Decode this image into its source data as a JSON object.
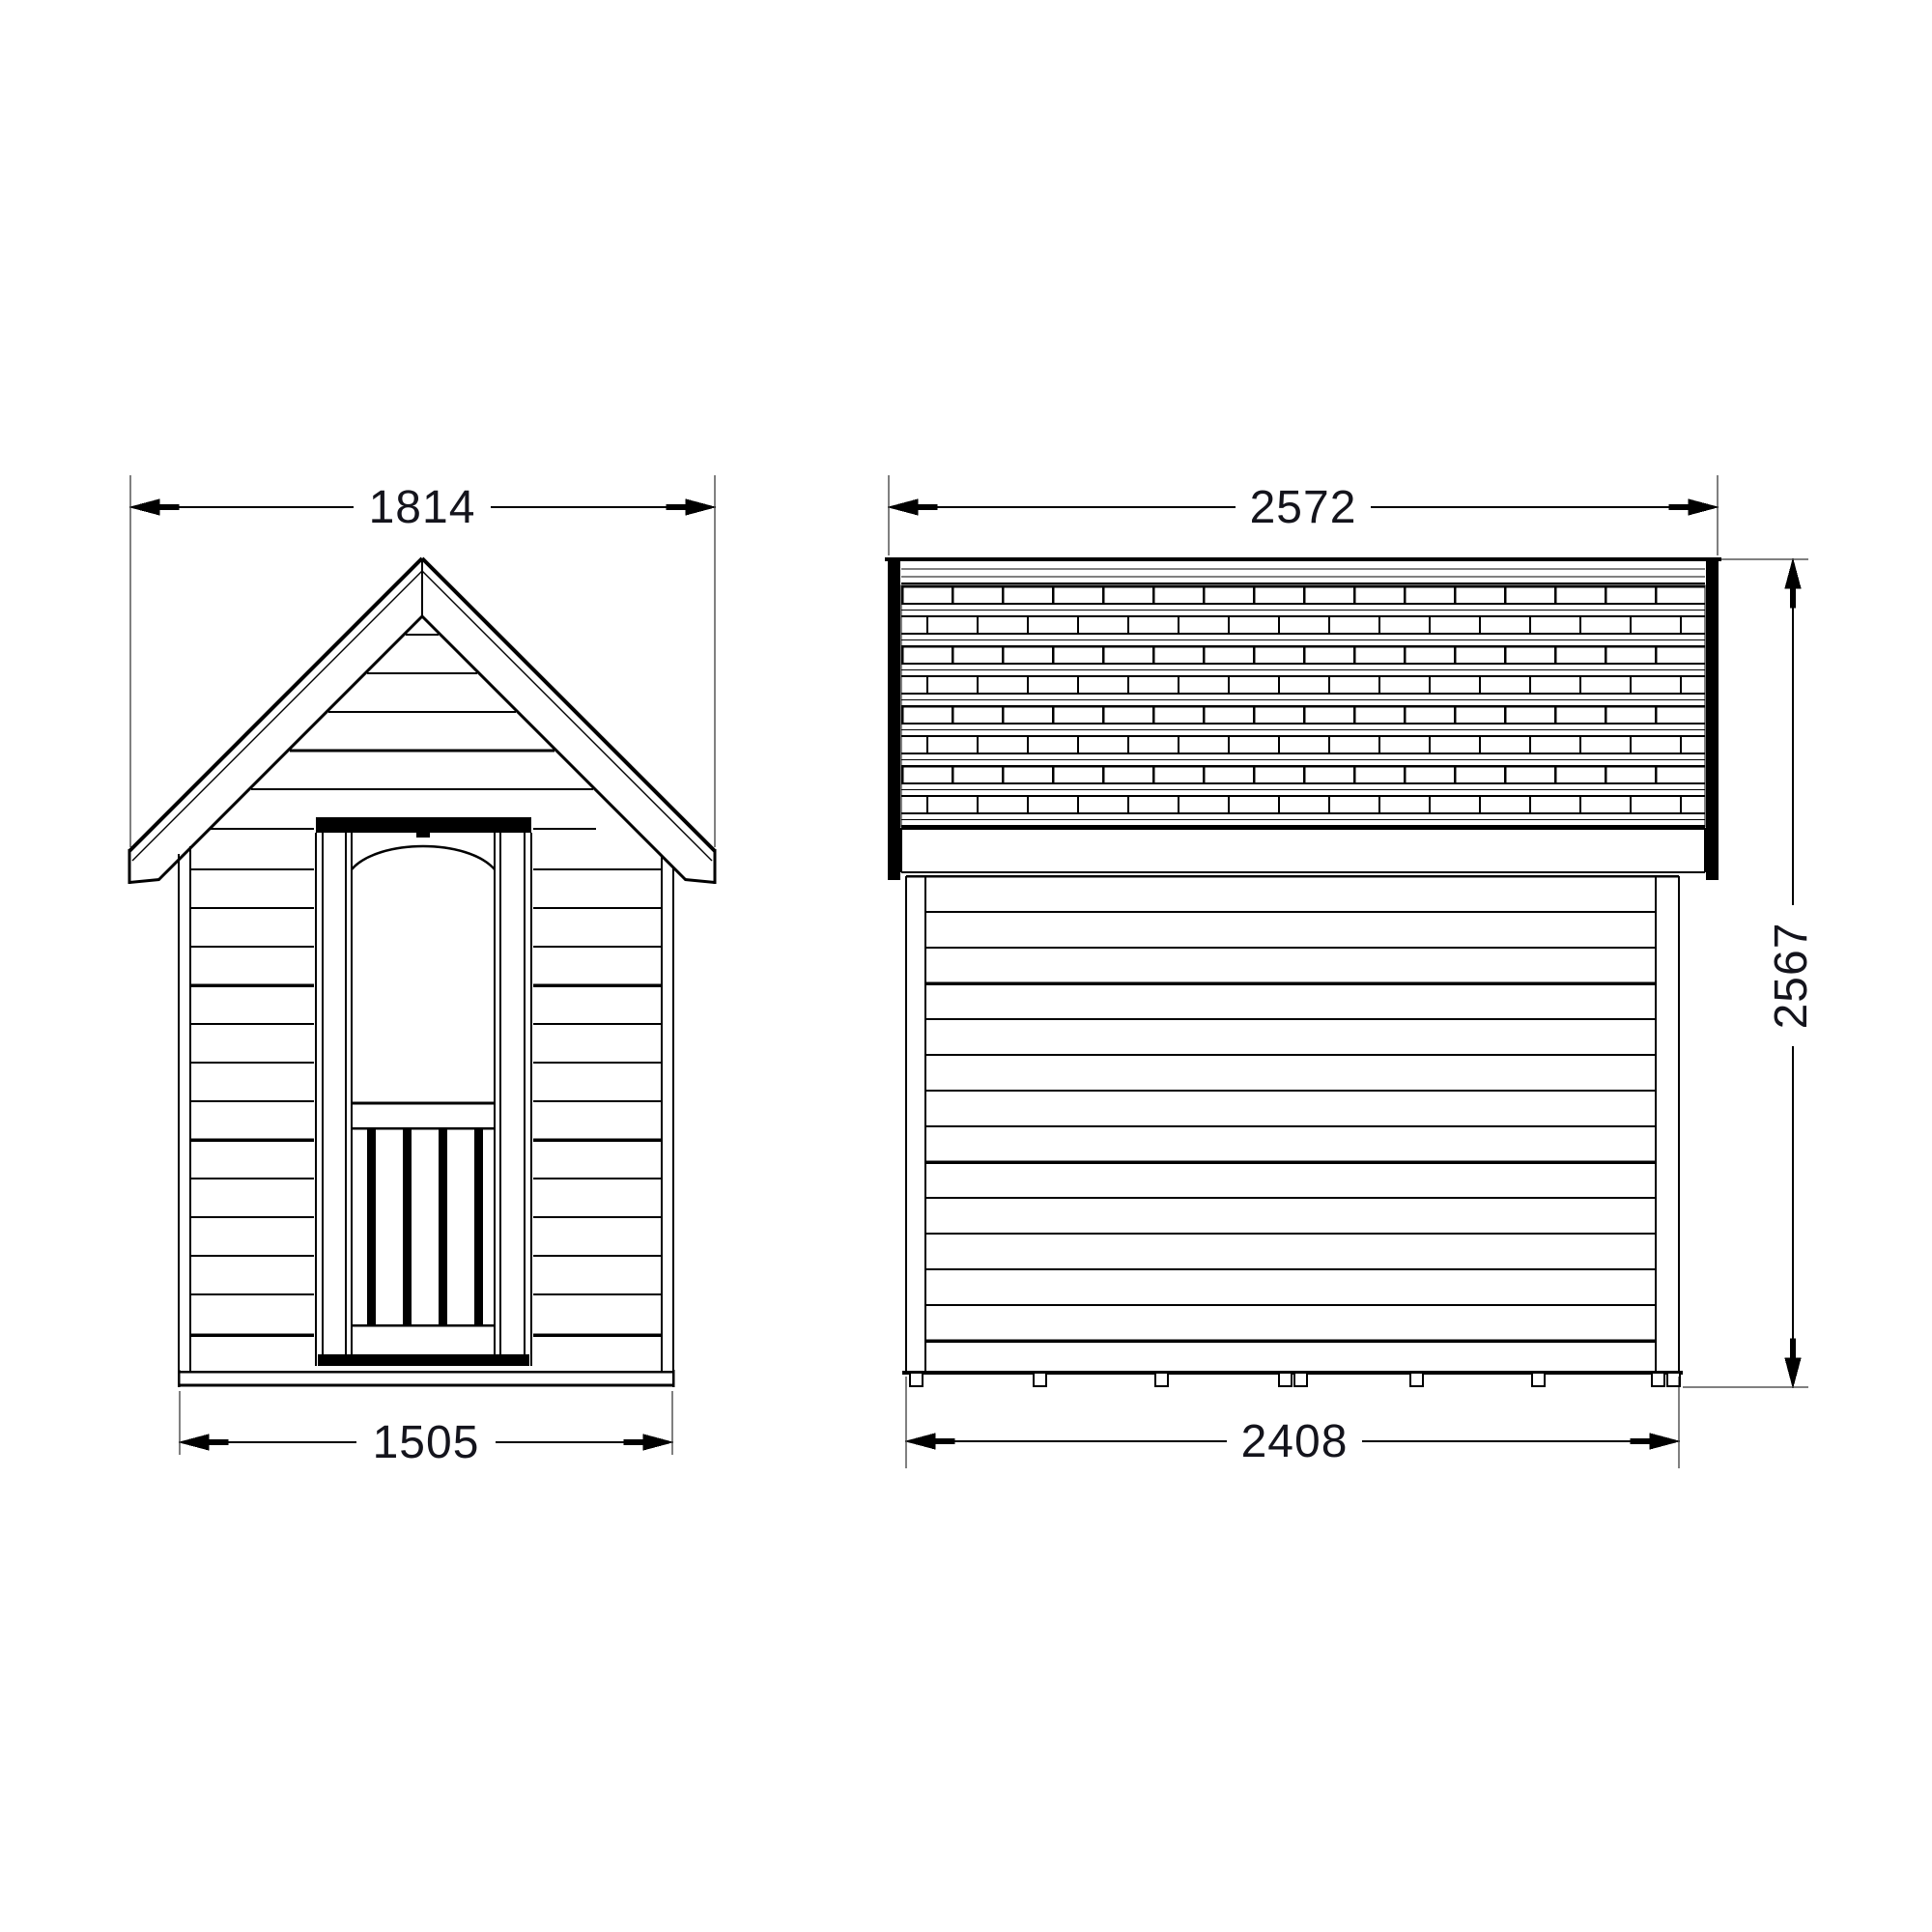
{
  "drawing": {
    "type": "technical-dimension-drawing",
    "subject": "garden shed / playhouse elevations",
    "unit": "mm",
    "line_color": "#000000",
    "text_color": "#14141c",
    "front_view": {
      "roof_width": "1814",
      "body_width": "1505"
    },
    "side_view": {
      "roof_length": "2572",
      "base_length": "2408",
      "overall_height": "2567"
    }
  }
}
